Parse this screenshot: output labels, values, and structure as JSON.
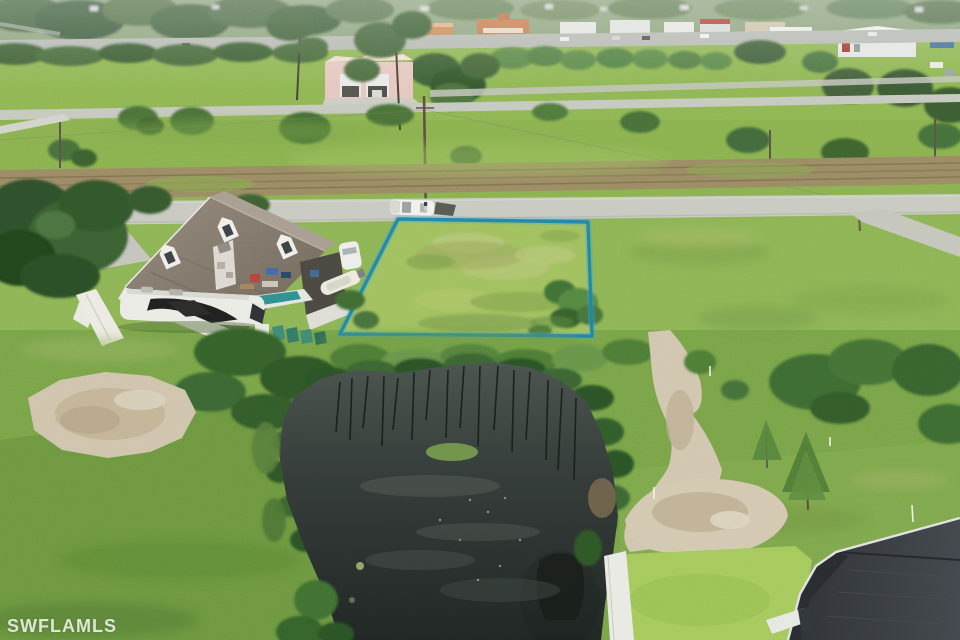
{
  "watermark": {
    "text": "SWFLAMLS"
  },
  "colors": {
    "lot_outline": "#1d83ab",
    "lot_outline_glow": "#3ba8cd",
    "watermark_text": "rgba(252,252,248,0.82)"
  },
  "scene": {
    "type": "aerial-drone-photo",
    "subject": "vacant residential lot highlighted with blue boundary",
    "visible_features": [
      "highlighted vacant lot",
      "two-story house with dormers",
      "motorhome-rv",
      "boats",
      "dark pond",
      "sandy paths",
      "residential road with white car",
      "distant commercial strip and highway",
      "pink garage building",
      "new house with dark roof (bottom right)"
    ]
  }
}
